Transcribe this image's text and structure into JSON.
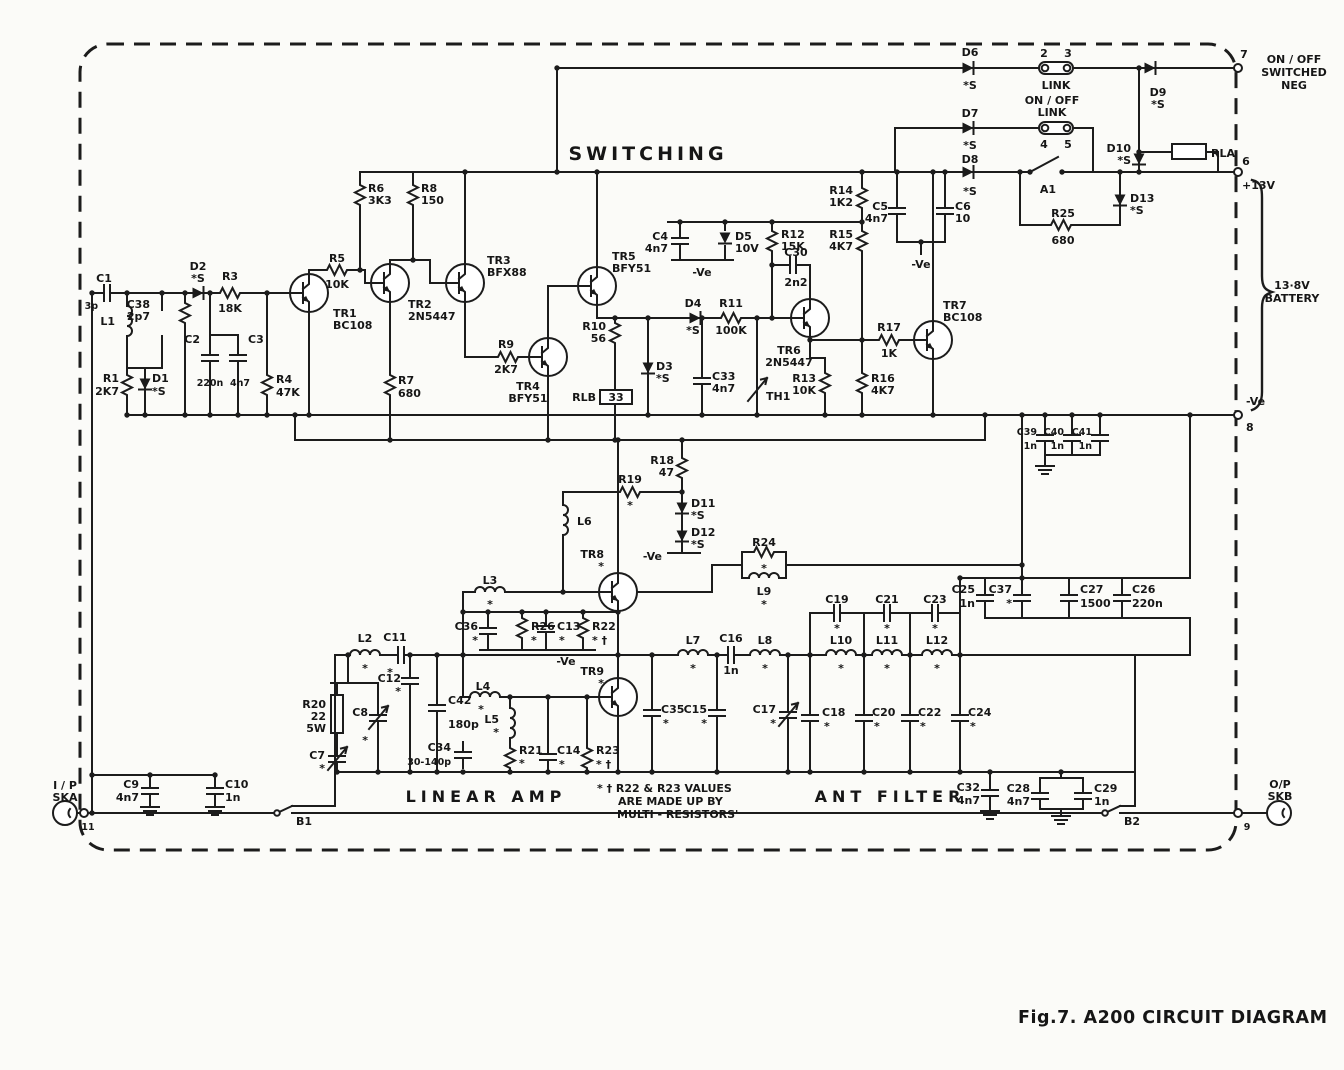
{
  "titles": {
    "switching": "SWITCHING",
    "amp": "LINEAR AMP",
    "filt": "ANT FILTER",
    "caption": "Fig.7.  A200 CIRCUIT DIAGRAM"
  },
  "power": {
    "plus": "+13V",
    "bat1": "13·8V",
    "bat2": "BATTERY"
  },
  "misc": {
    "neg": "-Ve",
    "sn": [
      "ON / OFF",
      "SWITCHED",
      "NEG"
    ]
  },
  "links": {
    "top": {
      "label": "LINK",
      "p2": "2",
      "p3": "3"
    },
    "onoff": {
      "l1": "ON / OFF",
      "l2": "LINK",
      "p4": "4",
      "p5": "5"
    }
  },
  "conn": {
    "in1": "I / P",
    "in2": "SKA",
    "inpin": "11",
    "out1": "O/P",
    "out2": "SKB",
    "outpin": "9",
    "b1": "B1",
    "b2": "B2",
    "p7": "7",
    "p6": "6",
    "p8": "8"
  },
  "note": {
    "l1": "* † R22 & R23 VALUES",
    "l2": "ARE MADE UP BY",
    "l3": "MULTI - RESISTORS'"
  },
  "c": {
    "r1": {
      "r": "R1",
      "v": "2K7"
    },
    "r2": {
      "r": "R2",
      "v": "1K"
    },
    "r3": {
      "r": "R3",
      "v": "18K"
    },
    "r4": {
      "r": "R4",
      "v": "47K"
    },
    "r5": {
      "r": "R5",
      "v": "10K"
    },
    "r6": {
      "r": "R6",
      "v": "3K3"
    },
    "r7": {
      "r": "R7",
      "v": "680"
    },
    "r8": {
      "r": "R8",
      "v": "150"
    },
    "r9": {
      "r": "R9",
      "v": "2K7"
    },
    "r10": {
      "r": "R10",
      "v": "56"
    },
    "r11": {
      "r": "R11",
      "v": "100K"
    },
    "r12": {
      "r": "R12",
      "v": "15K"
    },
    "r13": {
      "r": "R13",
      "v": "10K"
    },
    "r14": {
      "r": "R14",
      "v": "1K2"
    },
    "r15": {
      "r": "R15",
      "v": "4K7"
    },
    "r16": {
      "r": "R16",
      "v": "4K7"
    },
    "r17": {
      "r": "R17",
      "v": "1K"
    },
    "r18": {
      "r": "R18",
      "v": "47"
    },
    "r19": {
      "r": "R19",
      "v": "*"
    },
    "r20": {
      "r": "R20",
      "v": "22",
      "v2": "5W"
    },
    "r21": {
      "r": "R21",
      "v": "*"
    },
    "r22": {
      "r": "R22",
      "v": "* †"
    },
    "r23": {
      "r": "R23",
      "v": "* †"
    },
    "r24": {
      "r": "R24",
      "v": "*"
    },
    "r25": {
      "r": "R25",
      "v": "680"
    },
    "r26": {
      "r": "R26",
      "v": "*"
    },
    "c1": {
      "r": "C1",
      "v": "3p"
    },
    "c2": {
      "r": "C2",
      "v": "220n"
    },
    "c3": {
      "r": "C3",
      "v": "4n7"
    },
    "c4": {
      "r": "C4",
      "v": "4n7"
    },
    "c5": {
      "r": "C5",
      "v": "4n7"
    },
    "c6": {
      "r": "C6",
      "v": "10"
    },
    "c7": {
      "r": "C7",
      "v": "*"
    },
    "c8": {
      "r": "C8",
      "v": "*"
    },
    "c9": {
      "r": "C9",
      "v": "4n7"
    },
    "c10": {
      "r": "C10",
      "v": "1n"
    },
    "c11": {
      "r": "C11",
      "v": "*"
    },
    "c12": {
      "r": "C12",
      "v": "*"
    },
    "c13": {
      "r": "C13",
      "v": "*"
    },
    "c14": {
      "r": "C14",
      "v": "*"
    },
    "c15": {
      "r": "C15",
      "v": "*"
    },
    "c16": {
      "r": "C16",
      "v": "1n"
    },
    "c17": {
      "r": "C17",
      "v": "*"
    },
    "c18": {
      "r": "C18",
      "v": "*"
    },
    "c19": {
      "r": "C19",
      "v": "*"
    },
    "c20": {
      "r": "C20",
      "v": "*"
    },
    "c21": {
      "r": "C21",
      "v": "*"
    },
    "c22": {
      "r": "C22",
      "v": "*"
    },
    "c23": {
      "r": "C23",
      "v": "*"
    },
    "c24": {
      "r": "C24",
      "v": "*"
    },
    "c25": {
      "r": "C25",
      "v": "1n"
    },
    "c26": {
      "r": "C26",
      "v": "220n"
    },
    "c27": {
      "r": "C27",
      "v": "1500"
    },
    "c28": {
      "r": "C28",
      "v": "4n7"
    },
    "c29": {
      "r": "C29",
      "v": "1n"
    },
    "c30": {
      "r": "C30",
      "v": "2n2"
    },
    "c32": {
      "r": "C32",
      "v": "4n7"
    },
    "c33": {
      "r": "C33",
      "v": "4n7"
    },
    "c34": {
      "r": "C34",
      "v": "30-140p"
    },
    "c35": {
      "r": "C35",
      "v": "*"
    },
    "c36": {
      "r": "C36",
      "v": "*"
    },
    "c37": {
      "r": "C37",
      "v": "*"
    },
    "c38": {
      "r": "C38",
      "v": "2p7"
    },
    "c39": {
      "r": "C39",
      "v": "1n"
    },
    "c40": {
      "r": "C40",
      "v": "1n"
    },
    "c41": {
      "r": "C41",
      "v": "1n"
    },
    "c42": {
      "r": "C42",
      "v": "180p"
    },
    "d1": {
      "r": "D1",
      "v": "*S"
    },
    "d2": {
      "r": "D2",
      "v": "*S"
    },
    "d3": {
      "r": "D3",
      "v": "*S"
    },
    "d4": {
      "r": "D4",
      "v": "*S"
    },
    "d5": {
      "r": "D5",
      "v": "10V"
    },
    "d6": {
      "r": "D6",
      "v": "*S"
    },
    "d7": {
      "r": "D7",
      "v": "*S"
    },
    "d8": {
      "r": "D8",
      "v": "*S"
    },
    "d9": {
      "r": "D9",
      "v": "*S"
    },
    "d10": {
      "r": "D10",
      "v": "*S"
    },
    "d11": {
      "r": "D11",
      "v": "*S"
    },
    "d12": {
      "r": "D12",
      "v": "*S"
    },
    "d13": {
      "r": "D13",
      "v": "*S"
    },
    "tr1": {
      "r": "TR1",
      "v": "BC108"
    },
    "tr2": {
      "r": "TR2",
      "v": "2N5447"
    },
    "tr3": {
      "r": "TR3",
      "v": "BFX88"
    },
    "tr4": {
      "r": "TR4",
      "v": "BFY51"
    },
    "tr5": {
      "r": "TR5",
      "v": "BFY51"
    },
    "tr6": {
      "r": "TR6",
      "v": "2N5447"
    },
    "tr7": {
      "r": "TR7",
      "v": "BC108"
    },
    "tr8": {
      "r": "TR8",
      "v": "*"
    },
    "tr9": {
      "r": "TR9",
      "v": "*"
    },
    "l1": {
      "r": "L1"
    },
    "l2": {
      "r": "L2",
      "v": "*"
    },
    "l3": {
      "r": "L3",
      "v": "*"
    },
    "l4": {
      "r": "L4",
      "v": "*"
    },
    "l5": {
      "r": "L5",
      "v": "*"
    },
    "l6": {
      "r": "L6"
    },
    "l7": {
      "r": "L7",
      "v": "*"
    },
    "l8": {
      "r": "L8",
      "v": "*"
    },
    "l9": {
      "r": "L9",
      "v": "*"
    },
    "l10": {
      "r": "L10",
      "v": "*"
    },
    "l11": {
      "r": "L11",
      "v": "*"
    },
    "l12": {
      "r": "L12",
      "v": "*"
    },
    "th1": {
      "r": "TH1"
    },
    "rla": {
      "r": "RLA"
    },
    "rlb": {
      "r": "RLB",
      "v": "33"
    },
    "a1": {
      "r": "A1"
    }
  }
}
